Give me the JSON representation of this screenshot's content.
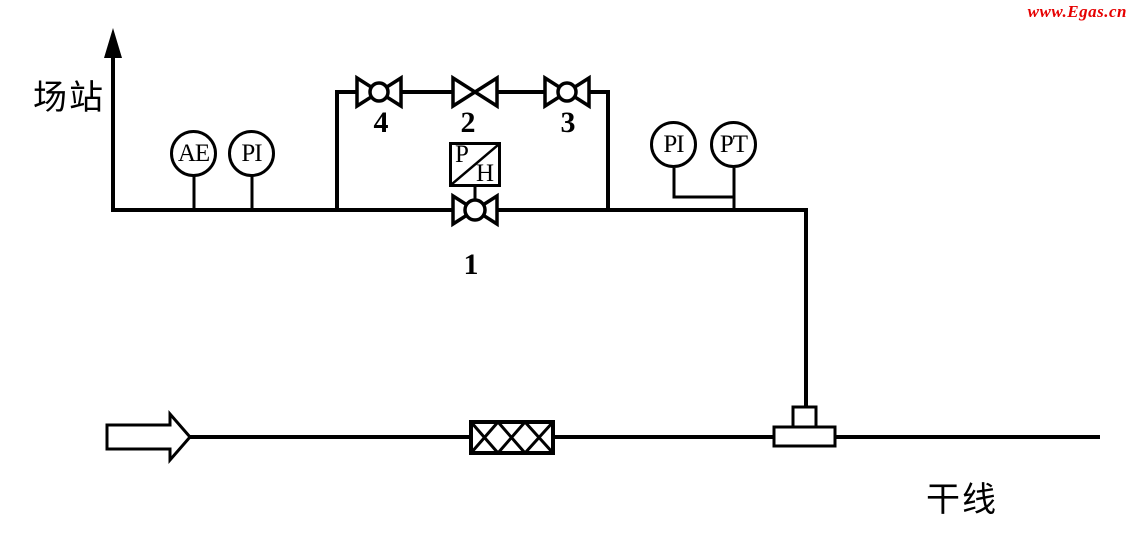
{
  "watermark": {
    "text": "www.Egas.cn",
    "color": "#e60000"
  },
  "diagram": {
    "station_label": "场站",
    "trunk_label": "干线",
    "instruments": {
      "ae": "AE",
      "pi_left": "PI",
      "pi_right": "PI",
      "pt": "PT"
    },
    "valve_labels": {
      "v1": "1",
      "v2": "2",
      "v3": "3",
      "v4": "4"
    },
    "regulator": {
      "letter_top": "P",
      "letter_bottom": "H"
    }
  },
  "colors": {
    "line": "#000000",
    "background": "#ffffff",
    "watermark_red": "#e60000"
  }
}
